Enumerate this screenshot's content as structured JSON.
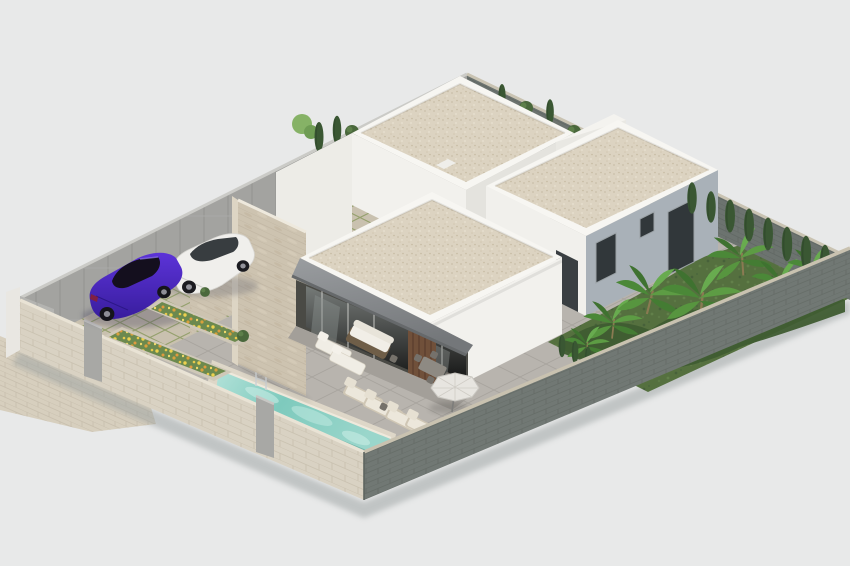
{
  "image": {
    "type": "architectural-3d-render",
    "view": "aerial-isometric",
    "description": "Photorealistic aerial isometric rendering of a modern flat-roof villa plot with swimming pool, sun terrace, two parked cars, flower planters, tropical garden and perimeter walls on a plain light-gray background"
  },
  "colors": {
    "background": "#e8e9e9",
    "white_wall": "#f2f1ed",
    "white_wall_shade": "#e4e3de",
    "parapet_white": "#f7f6f2",
    "facade_blue_gray": "#a9b1b8",
    "window_glass": "#31373a",
    "awning_gray": "#84878a",
    "porch_recess": "#4a4a45",
    "wood_door": "#70503a",
    "pool_water": "#7ecabd",
    "pool_coping": "#ded7c8",
    "terrace_tile": "#b8b4ae",
    "driveway_paver": "#c9c1af",
    "sidewalk_paver": "#d7cfbe",
    "stone_wall": "#d9d2c3",
    "dark_wall": "#717874",
    "gray_wall": "#a3a3a0",
    "stone_cladding": "#cdc3b0",
    "garden_grass": "#55703f",
    "cypress_green": "#3a5733",
    "palm_green": "#57953f",
    "flower_yellow": "#ecd14f",
    "flower_orange": "#e09a3f",
    "car_purple": "#4a25c8",
    "car_white": "#f0efec",
    "lounger_cushion": "#ece7db",
    "umbrella_canopy": "#e7e5e0",
    "gate_gray": "#b4b4b1",
    "pillar_gray": "#a8a8a5"
  },
  "scene": {
    "elements": {
      "back_villa": "Back villa block with gravel flat roof",
      "right_villa": "Right villa block with blue-gray side facade",
      "front_villa": "Front villa block with covered porch and awning",
      "stone_feature": "Travertine stone feature wall",
      "pool": "Rectangular swimming pool with chrome ladder",
      "driveway": "Grass-paver parking drive",
      "cars": "Purple sedan and white SUV",
      "planters": "Raised planters with yellow and orange flowers",
      "furniture": "Sun loungers, outdoor sofa, dining set and parasol",
      "garden": "Tropical garden with banana plants and cypress hedge",
      "walls": "Stone, gray and dark brick perimeter walls with entrance gate",
      "sidewalk": "Paved sidewalk outside the gate"
    }
  }
}
